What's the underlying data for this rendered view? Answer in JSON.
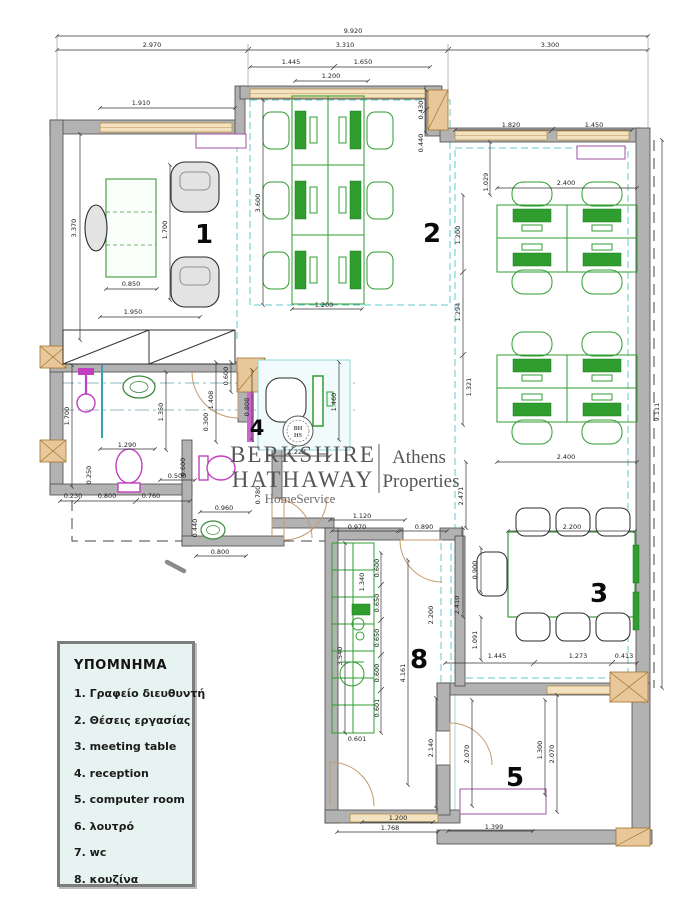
{
  "legend": {
    "title": "ΥΠΟΜΝΗΜΑ",
    "items": [
      "1. Γραφείο διευθυντή",
      "2. Θέσεις εργασίας",
      "3. meeting table",
      "4. reception",
      "5. computer room",
      "6. λουτρό",
      "7. wc",
      "8. κουζίνα"
    ]
  },
  "logo": {
    "line1": "BERKSHIRE",
    "line2": "HATHAWAY",
    "line3": "HomeService",
    "right_line1": "Athens",
    "right_line2": "Properties",
    "seal_line1": "BH",
    "seal_line2": "HS"
  },
  "rooms": {
    "r1": "1",
    "r2": "2",
    "r3": "3",
    "r4": "4",
    "r5": "5",
    "r8": "8"
  },
  "colors": {
    "furniture_green": "#2f9e2f",
    "plumbing_magenta": "#c040c0",
    "wall_gray": "#b2b2b2",
    "window_tan": "#f2e2c0",
    "ceiling_dash_teal": "#63c8c8",
    "legend_bg": "#e6f3f1",
    "logo_gray": "#565656"
  },
  "dims": {
    "d01": "9.920",
    "d02": "2.970",
    "d03": "3.310",
    "d04": "3.300",
    "d05": "1.445",
    "d06": "1.650",
    "d07": "1.200",
    "d08": "1.910",
    "d09": "1.820",
    "d10": "1.450",
    "d11": "0.850",
    "d12": "1.950",
    "d13": "2.400",
    "d14": "2.400",
    "d15": "2.200",
    "d16": "1.290",
    "d17": "0.500",
    "d18": "0.230",
    "d19": "0.800",
    "d20": "0.760",
    "d21": "0.960",
    "d22": "0.800",
    "d23": "1.120",
    "d24": "0.970",
    "d25": "0.890",
    "d26": "1.445",
    "d27": "1.273",
    "d28": "0.413",
    "d29": "1.224",
    "d30": "1.200",
    "d31": "0.601",
    "d32": "1.200",
    "d33": "1.768",
    "d34": "1.399",
    "d35": "3.370",
    "d36": "1.700",
    "d37": "3.600",
    "d38": "0.430",
    "d39": "0.440",
    "d40": "1.029",
    "d41": "1.200",
    "d42": "1.294",
    "d43": "1.321",
    "d44": "2.471",
    "d45": "9.111",
    "d46": "0.900",
    "d47": "2.410",
    "d48": "1.091",
    "d49": "1.700",
    "d50": "1.350",
    "d51": "1.408",
    "d52": "0.600",
    "d53": "0.300",
    "d54": "0.808",
    "d55": "1.460",
    "d56": "0.250",
    "d57": "0.600",
    "d58": "0.440",
    "d59": "3.540",
    "d60": "1.340",
    "d61": "0.600",
    "d62": "0.650",
    "d63": "0.650",
    "d64": "0.600",
    "d65": "0.601",
    "d66": "2.200",
    "d67": "4.161",
    "d68": "2.140",
    "d69": "2.070",
    "d70": "1.300",
    "d71": "2.070",
    "d72": "0.780"
  }
}
